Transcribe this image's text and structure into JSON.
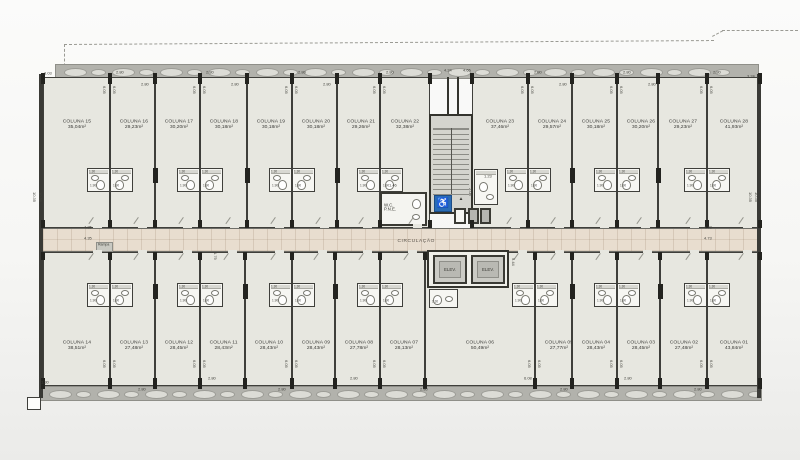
{
  "plan": {
    "corridor_label": "CIRCULAÇÃO",
    "elevator_label": "ELEV.",
    "wc_pne_line1": "W.C.",
    "wc_pne_line2": "P.N.E.",
    "ramp_label": "Rampa",
    "accessible_symbol": "♿",
    "colors": {
      "floor": "#e7e7e0",
      "wall": "#3f3f3b",
      "corridor": "#e8ddcf",
      "facade_band": "#b2b2ac",
      "accessible_blue": "#2a6cb5"
    },
    "pod_dims": {
      "width": "1.90",
      "depth": "1.30"
    },
    "vertical_bay_dim": "6.05",
    "units_top": [
      {
        "id": "COLUNA 15",
        "area": "35,04m²",
        "x": 43,
        "w": 67
      },
      {
        "id": "COLUNA 16",
        "area": "29,23m²",
        "x": 110,
        "w": 45
      },
      {
        "id": "COLUNA 17",
        "area": "30,20m²",
        "x": 155,
        "w": 45
      },
      {
        "id": "COLUNA 18",
        "area": "30,18m²",
        "x": 200,
        "w": 47
      },
      {
        "id": "COLUNA 19",
        "area": "30,18m²",
        "x": 247,
        "w": 45
      },
      {
        "id": "COLUNA 20",
        "area": "30,18m²",
        "x": 292,
        "w": 45
      },
      {
        "id": "COLUNA 21",
        "area": "29,26m²",
        "x": 337,
        "w": 43
      },
      {
        "id": "COLUNA 22",
        "area": "32,38m²",
        "x": 380,
        "w": 50
      },
      {
        "id": "COLUNA 23",
        "area": "37,46m²",
        "x": 472,
        "w": 56
      },
      {
        "id": "COLUNA 24",
        "area": "29,57m²",
        "x": 528,
        "w": 44
      },
      {
        "id": "COLUNA 25",
        "area": "30,18m²",
        "x": 572,
        "w": 45
      },
      {
        "id": "COLUNA 26",
        "area": "30,20m²",
        "x": 617,
        "w": 41
      },
      {
        "id": "COLUNA 27",
        "area": "29,23m²",
        "x": 658,
        "w": 49
      },
      {
        "id": "COLUNA 28",
        "area": "41,93m²",
        "x": 707,
        "w": 53
      }
    ],
    "units_bottom": [
      {
        "id": "COLUNA 14",
        "area": "38,51m²",
        "x": 43,
        "w": 67
      },
      {
        "id": "COLUNA 13",
        "area": "27,48m²",
        "x": 110,
        "w": 45
      },
      {
        "id": "COLUNA 12",
        "area": "28,45m²",
        "x": 155,
        "w": 45
      },
      {
        "id": "COLUNA 11",
        "area": "28,43m²",
        "x": 200,
        "w": 45
      },
      {
        "id": "COLUNA 10",
        "area": "28,43m²",
        "x": 245,
        "w": 47
      },
      {
        "id": "COLUNA 09",
        "area": "28,43m²",
        "x": 292,
        "w": 43
      },
      {
        "id": "COLUNA 08",
        "area": "27,78m²",
        "x": 335,
        "w": 45
      },
      {
        "id": "COLUNA 07",
        "area": "28,13m²",
        "x": 380,
        "w": 45
      },
      {
        "id": "COLUNA 06",
        "area": "50,49m²",
        "x": 425,
        "w": 110
      },
      {
        "id": "COLUNA 05",
        "area": "27,77m²",
        "x": 535,
        "w": 37
      },
      {
        "id": "COLUNA 04",
        "area": "28,43m²",
        "x": 572,
        "w": 45
      },
      {
        "id": "COLUNA 03",
        "area": "28,45m²",
        "x": 617,
        "w": 43
      },
      {
        "id": "COLUNA 02",
        "area": "27,48m²",
        "x": 660,
        "w": 47
      },
      {
        "id": "COLUNA 01",
        "area": "43,84m²",
        "x": 707,
        "w": 53
      }
    ],
    "pods_top_walls": [
      110,
      200,
      292,
      380,
      528,
      617,
      707
    ],
    "pods_bottom_walls": [
      110,
      200,
      292,
      380,
      535,
      617,
      707
    ],
    "chunk_walls_top": [
      155,
      247,
      337,
      572,
      658
    ],
    "chunk_walls_bottom": [
      155,
      245,
      335,
      572,
      660
    ],
    "dims": [
      {
        "t": "3.03",
        "x": 44,
        "y": 71
      },
      {
        "t": "2.80",
        "x": 116,
        "y": 70
      },
      {
        "t": "2.80",
        "x": 141,
        "y": 82
      },
      {
        "t": "2.80",
        "x": 206,
        "y": 70
      },
      {
        "t": "2.80",
        "x": 231,
        "y": 82
      },
      {
        "t": "2.80",
        "x": 298,
        "y": 70
      },
      {
        "t": "2.80",
        "x": 323,
        "y": 82
      },
      {
        "t": "2.80",
        "x": 386,
        "y": 70
      },
      {
        "t": "4.24",
        "x": 444,
        "y": 68
      },
      {
        "t": "4.65",
        "x": 463,
        "y": 68
      },
      {
        "t": "2.80",
        "x": 534,
        "y": 70
      },
      {
        "t": "2.80",
        "x": 559,
        "y": 82
      },
      {
        "t": "2.80",
        "x": 623,
        "y": 70
      },
      {
        "t": "2.80",
        "x": 648,
        "y": 82
      },
      {
        "t": "2.80",
        "x": 713,
        "y": 70
      },
      {
        "t": "3.24",
        "x": 747,
        "y": 74
      },
      {
        "t": "10.35",
        "x": 32,
        "y": 192,
        "v": 1
      },
      {
        "t": "10.35",
        "x": 38,
        "y": 192,
        "v": 1
      },
      {
        "t": "4.35",
        "x": 84,
        "y": 225
      },
      {
        "t": "4.35",
        "x": 84,
        "y": 236
      },
      {
        "t": "4.73",
        "x": 704,
        "y": 225
      },
      {
        "t": "4.73",
        "x": 704,
        "y": 236
      },
      {
        "t": "10.35",
        "x": 748,
        "y": 192,
        "v": 1
      },
      {
        "t": "10.35",
        "x": 754,
        "y": 192,
        "v": 1
      },
      {
        "t": "1.23",
        "x": 484,
        "y": 174
      },
      {
        "t": "1.46",
        "x": 389,
        "y": 183
      },
      {
        "t": "2.08",
        "x": 468,
        "y": 188,
        "v": 1
      },
      {
        "t": "1.79",
        "x": 213,
        "y": 252,
        "v": 1
      },
      {
        "t": "9.44",
        "x": 511,
        "y": 258,
        "v": 1
      },
      {
        "t": "1.30",
        "x": 41,
        "y": 380
      },
      {
        "t": "2.80",
        "x": 138,
        "y": 387
      },
      {
        "t": "2.80",
        "x": 208,
        "y": 376
      },
      {
        "t": "2.80",
        "x": 278,
        "y": 387
      },
      {
        "t": "2.80",
        "x": 350,
        "y": 376
      },
      {
        "t": "2.80",
        "x": 420,
        "y": 387
      },
      {
        "t": "6.08",
        "x": 524,
        "y": 376
      },
      {
        "t": "2.80",
        "x": 560,
        "y": 387
      },
      {
        "t": "2.80",
        "x": 624,
        "y": 376
      },
      {
        "t": "2.80",
        "x": 694,
        "y": 387
      },
      {
        "t": "3.63",
        "x": 756,
        "y": 388,
        "v": 1
      }
    ]
  }
}
